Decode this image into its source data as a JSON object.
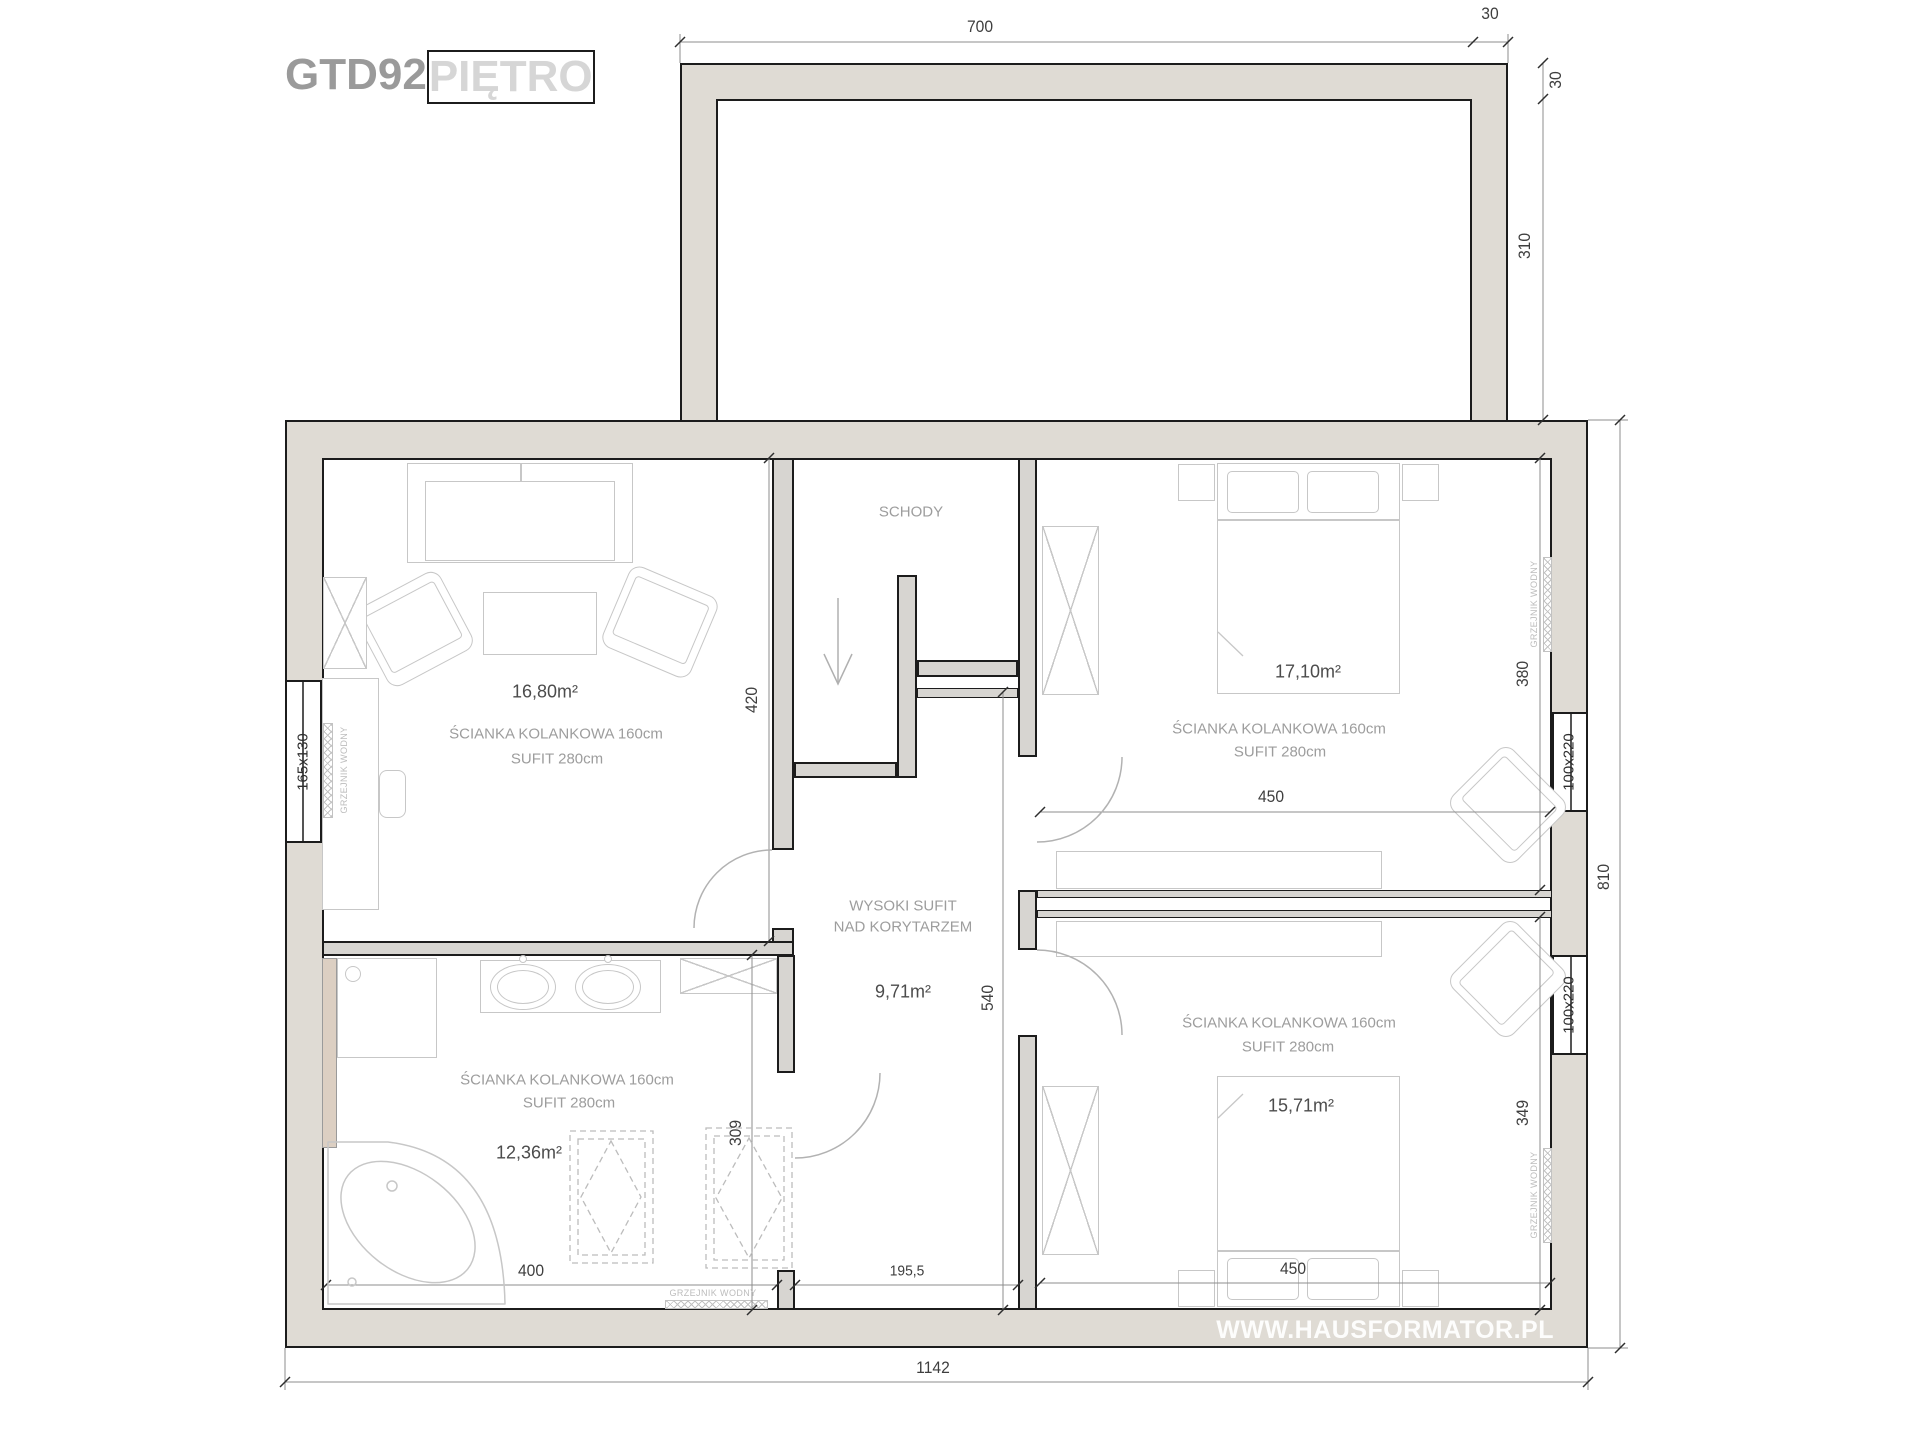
{
  "title": {
    "code": "GTD92",
    "floor": "PIĘTRO"
  },
  "watermark": "WWW.HAUSFORMATOR.PL",
  "rooms": {
    "living": {
      "area": "16,80m²",
      "knee_wall": "ŚCIANKA KOLANKOWA 160cm",
      "ceiling": "SUFIT 280cm"
    },
    "bedroom_top": {
      "area": "17,10m²",
      "knee_wall": "ŚCIANKA KOLANKOWA 160cm",
      "ceiling": "SUFIT 280cm"
    },
    "bedroom_bottom": {
      "area": "15,71m²",
      "knee_wall": "ŚCIANKA KOLANKOWA 160cm",
      "ceiling": "SUFIT 280cm"
    },
    "bathroom": {
      "area": "12,36m²",
      "knee_wall": "ŚCIANKA KOLANKOWA 160cm",
      "ceiling": "SUFIT 280cm"
    },
    "stairs": {
      "label": "SCHODY"
    },
    "corridor": {
      "line1": "WYSOKI SUFIT",
      "line2": "NAD KORYTARZEM",
      "area": "9,71m²"
    }
  },
  "dimensions": {
    "top_width": "700",
    "top_wall": "30",
    "right_wall": "30",
    "upper_depth": "310",
    "main_height": "810",
    "total_width": "1142",
    "living_height": "420",
    "bath_width": "400",
    "bath_height": "309",
    "corridor_height": "540",
    "corridor_width": "195,5",
    "bedroom_top_width": "450",
    "bedroom_top_height": "380",
    "bedroom_bottom_width": "450",
    "bedroom_bottom_height": "349"
  },
  "windows": {
    "left": "165x130",
    "right_top": "100x220",
    "right_bottom": "100x220"
  },
  "radiator": {
    "label": "GRZEJNIK WODNY"
  },
  "colors": {
    "wall_fill": "#dfdbd4",
    "partition_fill": "#d7d5d1",
    "line_dark": "#1c1c1c",
    "dim_text": "#3e3e3e",
    "label_gray": "#9d9d9d",
    "furniture_line": "#c7c7c7",
    "accent_tan": "#dccfc2",
    "watermark_text": "#ffffff"
  }
}
